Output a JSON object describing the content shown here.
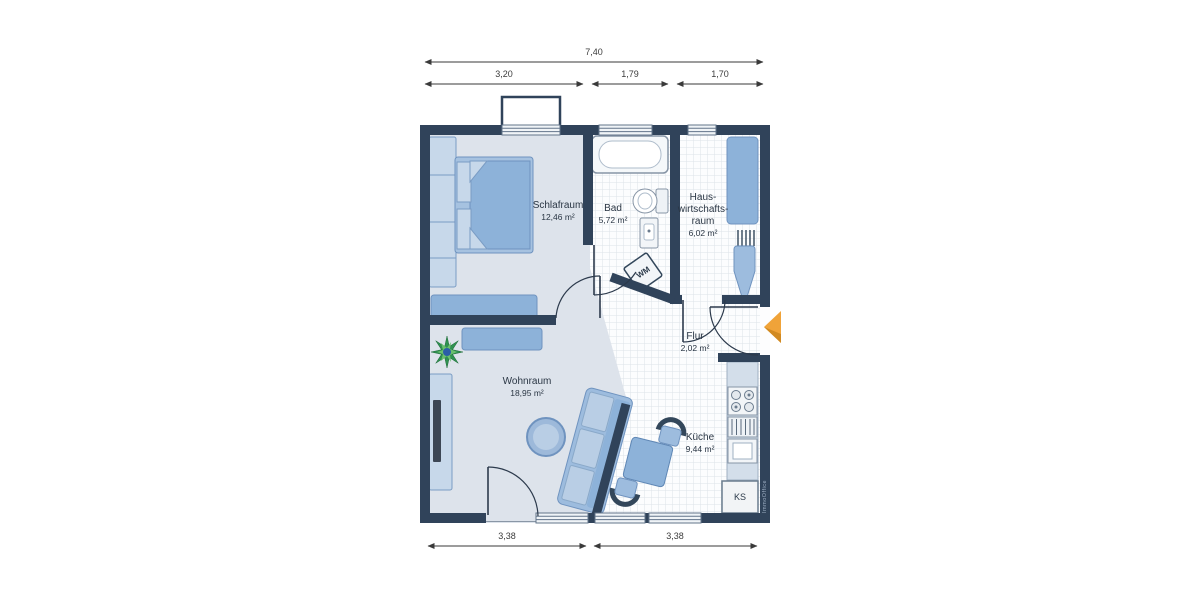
{
  "title": "Apartment floor plan",
  "rooms": {
    "schlafraum": {
      "name": "Schlafraum",
      "area": "12,46 m²"
    },
    "bad": {
      "name": "Bad",
      "area": "5,72 m²"
    },
    "hauswirtschaftsraum": {
      "line1": "Haus-",
      "line2": "wirtschafts-",
      "line3": "raum",
      "area": "6,02 m²"
    },
    "flur": {
      "name": "Flur",
      "area": "2,02 m²"
    },
    "wohnraum": {
      "name": "Wohnraum",
      "area": "18,95 m²"
    },
    "kueche": {
      "name": "Küche",
      "area": "9,44 m²"
    }
  },
  "appliances": {
    "washing_machine": "WM",
    "fridge": "KS"
  },
  "dimensions": {
    "top_total": "7,40",
    "top_segments": [
      "3,20",
      "1,79",
      "1,70"
    ],
    "bottom_segments": [
      "3,38",
      "3,38"
    ]
  },
  "watermark": "ImmoOffice",
  "colors": {
    "wall": "#30435a",
    "floor": "#dde3eb",
    "tile_line": "#dde2e8",
    "furniture_blue": "#8db2d9",
    "furniture_light": "#b9cee5",
    "accent_arrow": "#f0a339"
  }
}
